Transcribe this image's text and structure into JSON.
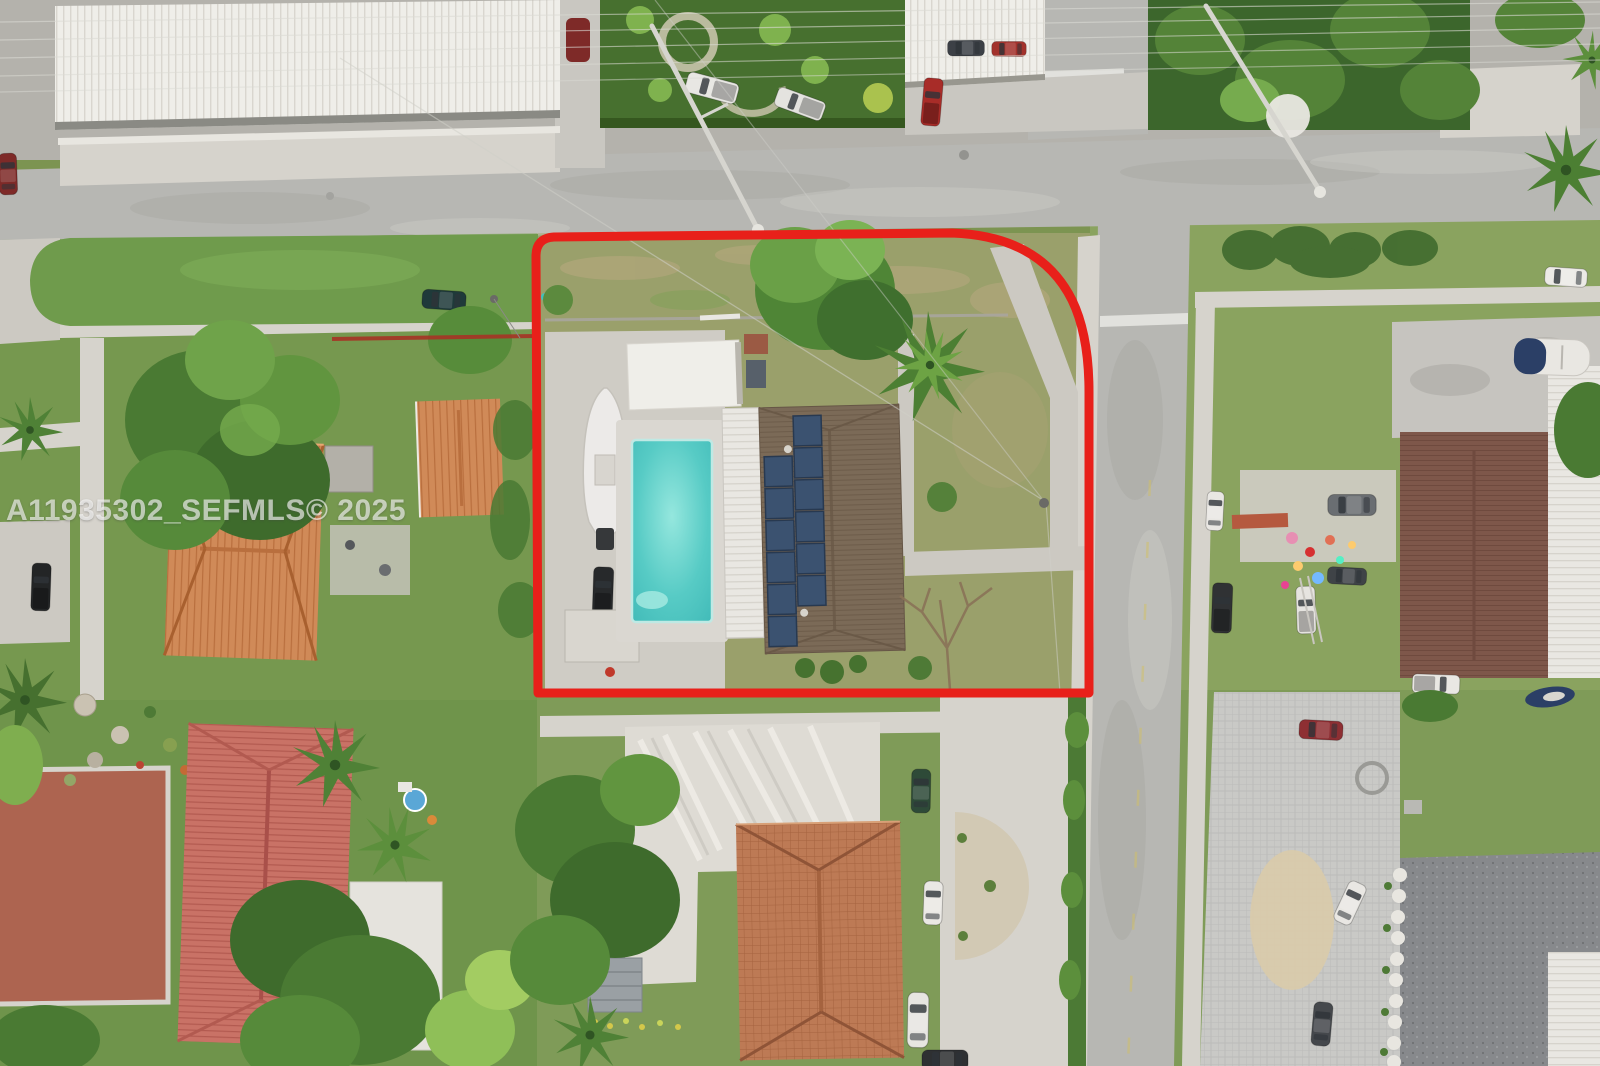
{
  "meta": {
    "type": "aerial-drone-photograph",
    "description": "Overhead aerial view of a suburban residential block; the subject corner lot is outlined in red and contains a house with rooftop solar panels, a swimming pool, a boat, and a white canopy carport.",
    "width_px": 1600,
    "height_px": 1066
  },
  "watermark": {
    "text": "A11935302_SEFMLS© 2025",
    "color": "rgba(255,255,255,0.62)"
  },
  "overlay": {
    "boundary_color": "#e8201a",
    "boundary_shape": "rounded-corner rectangle around the subject corner lot"
  },
  "palette": {
    "asphalt": "#b7b7b3",
    "concrete": "#d6d3cc",
    "lot_grass": "#9aa06b",
    "lawn_green": "#7f9b58",
    "tree_dark": "#3e6b2f",
    "tree_mid": "#55863b",
    "tree_light": "#76ab4e",
    "pool_water": "#57cbc5",
    "subject_roof_brown": "#7b6a57",
    "solar_panel_blue": "#3b5270",
    "white_roof": "#e9e7e2",
    "orange_tile_roof": "#d08a58",
    "pink_tile_roof": "#c97266",
    "terracotta_roof": "#bd7a55",
    "maroon_roof": "#7e574a",
    "gravel_roof": "#87898c"
  },
  "scene": {
    "subject_lot_features": [
      "red boundary outline",
      "corner lot",
      "swimming pool",
      "screened patio roof",
      "rooftop solar panels",
      "boat on trailer",
      "white canopy carport",
      "black pickup truck",
      "storage shed",
      "back lawn with bare tree"
    ],
    "context_features": [
      "street intersection",
      "parked cars and pickups",
      "neighboring tile-roof houses",
      "palm trees",
      "overhead power lines",
      "street light poles",
      "sidewalks",
      "crosswalk and road markings"
    ]
  }
}
